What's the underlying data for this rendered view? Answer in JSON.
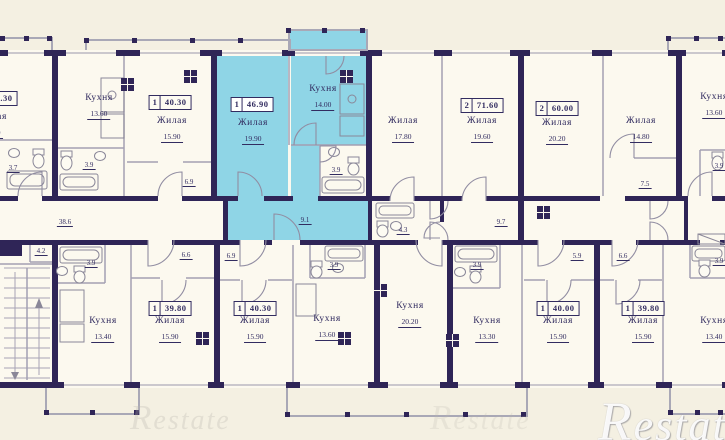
{
  "plan": {
    "watermark": "Restate",
    "shaft": {
      "line1": "Шахта",
      "line2": "дымоудал."
    },
    "colors": {
      "wall": "#2f2557",
      "highlight": "#8fd5e6",
      "paper": "#f4f0e2",
      "room": "#fcf9ef",
      "text": "#322c60"
    },
    "apartment_tags": [
      {
        "rooms": "1",
        "area": "40.30",
        "x": -4,
        "y": 91,
        "highlight": false
      },
      {
        "rooms": "1",
        "area": "40.30",
        "x": 170,
        "y": 95,
        "highlight": false
      },
      {
        "rooms": "1",
        "area": "46.90",
        "x": 252,
        "y": 97,
        "highlight": true
      },
      {
        "rooms": "2",
        "area": "71.60",
        "x": 482,
        "y": 98,
        "highlight": false
      },
      {
        "rooms": "2",
        "area": "60.00",
        "x": 557,
        "y": 101,
        "highlight": false
      },
      {
        "rooms": "1",
        "area": "39.80",
        "x": 170,
        "y": 301,
        "highlight": false
      },
      {
        "rooms": "1",
        "area": "40.30",
        "x": 255,
        "y": 301,
        "highlight": false
      },
      {
        "rooms": "1",
        "area": "40.00",
        "x": 558,
        "y": 301,
        "highlight": false
      },
      {
        "rooms": "1",
        "area": "39.80",
        "x": 643,
        "y": 301,
        "highlight": false
      }
    ],
    "room_labels": [
      {
        "name": "Жилая",
        "area": "15.90",
        "x": -8,
        "y": 112
      },
      {
        "name": "Кухня",
        "area": "13.60",
        "x": 99,
        "y": 93
      },
      {
        "name": "Жилая",
        "area": "15.90",
        "x": 172,
        "y": 116
      },
      {
        "name": "Жилая",
        "area": "19.90",
        "x": 253,
        "y": 118
      },
      {
        "name": "Кухня",
        "area": "14.00",
        "x": 323,
        "y": 84
      },
      {
        "name": "Жилая",
        "area": "17.80",
        "x": 403,
        "y": 116
      },
      {
        "name": "Жилая",
        "area": "19.60",
        "x": 482,
        "y": 116
      },
      {
        "name": "Жилая",
        "area": "20.20",
        "x": 557,
        "y": 118
      },
      {
        "name": "Жилая",
        "area": "14.80",
        "x": 641,
        "y": 116
      },
      {
        "name": "Кухня",
        "area": "13.60",
        "x": 714,
        "y": 92
      },
      {
        "name": "Кухня",
        "area": "13.40",
        "x": 103,
        "y": 316
      },
      {
        "name": "Жилая",
        "area": "15.90",
        "x": 170,
        "y": 316
      },
      {
        "name": "Жилая",
        "area": "15.90",
        "x": 255,
        "y": 316
      },
      {
        "name": "Кухня",
        "area": "13.60",
        "x": 327,
        "y": 314
      },
      {
        "name": "Кухня",
        "area": "20.20",
        "x": 410,
        "y": 301
      },
      {
        "name": "Кухня",
        "area": "13.30",
        "x": 487,
        "y": 316
      },
      {
        "name": "Жилая",
        "area": "15.90",
        "x": 558,
        "y": 316
      },
      {
        "name": "Жилая",
        "area": "15.90",
        "x": 643,
        "y": 316
      },
      {
        "name": "Кухня",
        "area": "13.40",
        "x": 714,
        "y": 316
      }
    ],
    "area_marks": [
      {
        "v": "3.7",
        "x": 13,
        "y": 164
      },
      {
        "v": "3.9",
        "x": 89,
        "y": 161
      },
      {
        "v": "6.9",
        "x": 189,
        "y": 178
      },
      {
        "v": "3.9",
        "x": 336,
        "y": 166
      },
      {
        "v": "9.1",
        "x": 305,
        "y": 216
      },
      {
        "v": "4.3",
        "x": 403,
        "y": 226
      },
      {
        "v": "9.7",
        "x": 501,
        "y": 218
      },
      {
        "v": "7.5",
        "x": 645,
        "y": 180
      },
      {
        "v": "3.9",
        "x": 719,
        "y": 162
      },
      {
        "v": "38.6",
        "x": 65,
        "y": 218
      },
      {
        "v": "4.2",
        "x": 41,
        "y": 247
      },
      {
        "v": "3.9",
        "x": 91,
        "y": 259
      },
      {
        "v": "6.6",
        "x": 186,
        "y": 251
      },
      {
        "v": "6.9",
        "x": 231,
        "y": 252
      },
      {
        "v": "3.9",
        "x": 334,
        "y": 261
      },
      {
        "v": "3.9",
        "x": 477,
        "y": 261
      },
      {
        "v": "5.9",
        "x": 577,
        "y": 252
      },
      {
        "v": "6.6",
        "x": 623,
        "y": 252
      },
      {
        "v": "3.9",
        "x": 719,
        "y": 257
      }
    ]
  }
}
